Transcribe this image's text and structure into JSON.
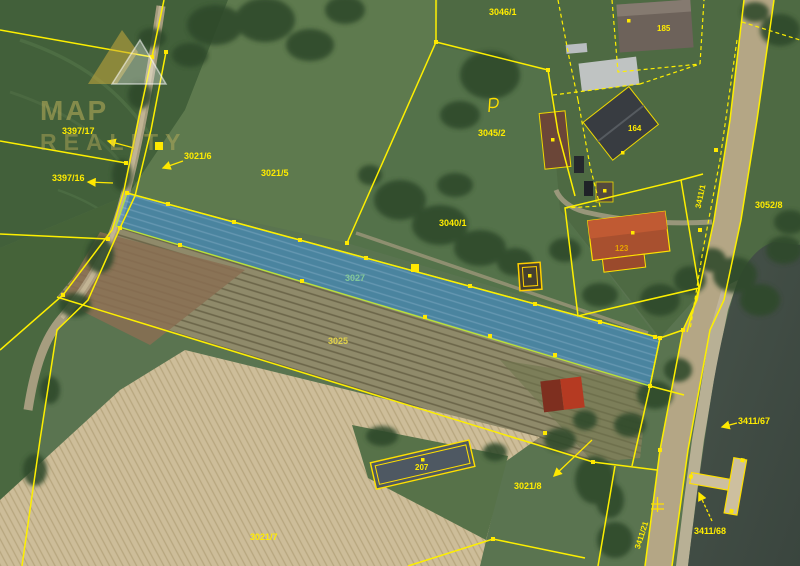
{
  "map": {
    "highlighted_parcel": {
      "number": "3027",
      "fill": "rgba(64,142,208,0.62)",
      "outline": "#b9e13a"
    },
    "colors": {
      "boundary_yellow": "#fdef00",
      "label_yellow": "#ffec00",
      "river": "#414c44",
      "road": "#b4a685",
      "field_tan": "#cdbd99",
      "field_furrow": "#8f8a6a",
      "meadow_green": "#5e7a4e"
    },
    "labels": {
      "p3397_17": "3397/17",
      "p3397_16": "3397/16",
      "p3021_6": "3021/6",
      "p3021_5": "3021/5",
      "p3040_1": "3040/1",
      "p3045_2": "3045/2",
      "p3046_1": "3046/1",
      "p3052_8": "3052/8",
      "p3027": "3027",
      "p3025": "3025",
      "p3021_7": "3021/7",
      "p3021_8": "3021/8",
      "p3411_67": "3411/67",
      "p3411_68": "3411/68",
      "p3411_21": "3411/21",
      "p3411_1": "3411/1",
      "h185": "185",
      "h164": "164",
      "h123": "123",
      "h207": "207"
    },
    "watermark": {
      "line1": "MAP",
      "line2": "REALITY"
    }
  }
}
